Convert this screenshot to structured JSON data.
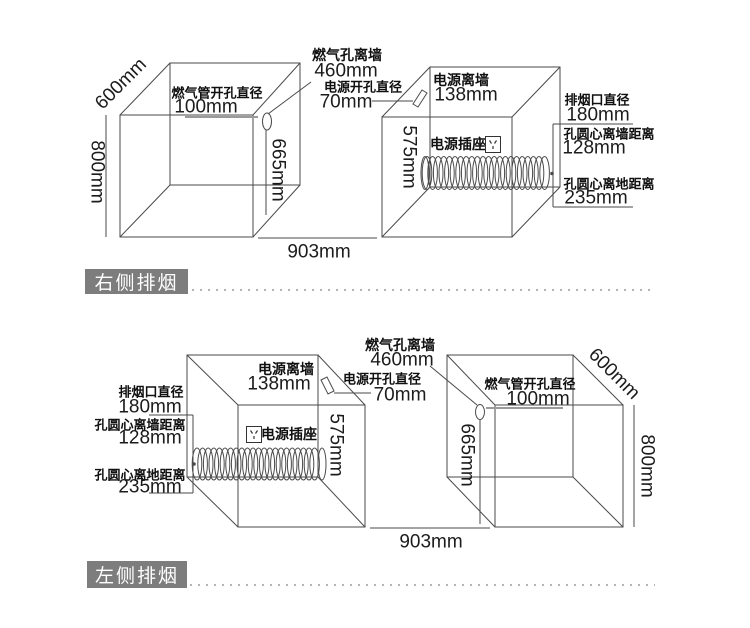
{
  "colors": {
    "badge_bg": "#7d7d7d",
    "badge_text": "#ffffff",
    "line": "#4a4a4a",
    "pointer_line": "#9a9a9a"
  },
  "sections": {
    "top": {
      "badge": "右侧排烟",
      "dim_600": "600mm",
      "dim_800": "800mm",
      "dim_903": "903mm",
      "dim_665": "665mm",
      "dim_575": "575mm",
      "gas_hole_title": "燃气管开孔直径",
      "gas_hole_value": "100mm",
      "gas_wall_title": "燃气孔离墙",
      "gas_wall_value": "460mm",
      "power_hole_title": "电源开孔直径",
      "power_hole_value": "70mm",
      "power_wall_title": "电源离墙",
      "power_wall_value": "138mm",
      "socket_label": "电源插座",
      "vent_title": "排烟口直径",
      "vent_value": "180mm",
      "hole_wall_title": "孔圆心离墙距离",
      "hole_wall_value": "128mm",
      "hole_floor_title": "孔圆心离地距离",
      "hole_floor_value": "235mm"
    },
    "bottom": {
      "badge": "左侧排烟",
      "dim_600": "600mm",
      "dim_800": "800mm",
      "dim_903": "903mm",
      "dim_665": "665mm",
      "dim_575": "575mm",
      "gas_hole_title": "燃气管开孔直径",
      "gas_hole_value": "100mm",
      "gas_wall_title": "燃气孔离墙",
      "gas_wall_value": "460mm",
      "power_hole_title": "电源开孔直径",
      "power_hole_value": "70mm",
      "power_wall_title": "电源离墙",
      "power_wall_value": "138mm",
      "socket_label": "电源插座",
      "vent_title": "排烟口直径",
      "vent_value": "180mm",
      "hole_wall_title": "孔圆心离墙距离",
      "hole_wall_value": "128mm",
      "hole_floor_title": "孔圆心离地距离",
      "hole_floor_value": "235mm"
    }
  }
}
